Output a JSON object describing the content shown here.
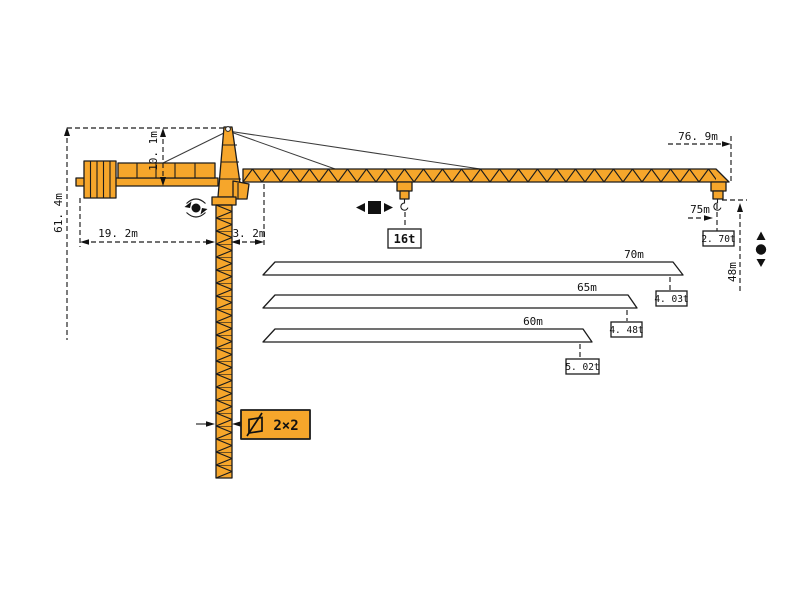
{
  "diagram": {
    "type": "tower-crane-specification-drawing",
    "colors": {
      "crane_orange": "#F6A62B",
      "outline": "#1c1c1c",
      "text": "#111111",
      "background": "#ffffff"
    },
    "dims": {
      "total_height": "61. 4m",
      "head_height": "10. 1m",
      "counter_jib_length": "19. 2m",
      "rear_offset": "3. 2m",
      "jib_overall": "76. 9m",
      "max_radius": "75m",
      "tip_capacity": "2. 70t",
      "max_capacity": "16t",
      "hook_height": "48m",
      "mast_section": "2×2"
    },
    "jib_options": [
      {
        "length": "70m",
        "tip_capacity": "4. 03t"
      },
      {
        "length": "65m",
        "tip_capacity": "4. 48t"
      },
      {
        "length": "60m",
        "tip_capacity": "5. 02t"
      }
    ],
    "icons": {
      "slewing": "rotation-icon",
      "trolley_travel": "trolley-travel-icon",
      "hoist": "hoist-up-down-icon",
      "mast_section": "square-section-icon"
    }
  }
}
